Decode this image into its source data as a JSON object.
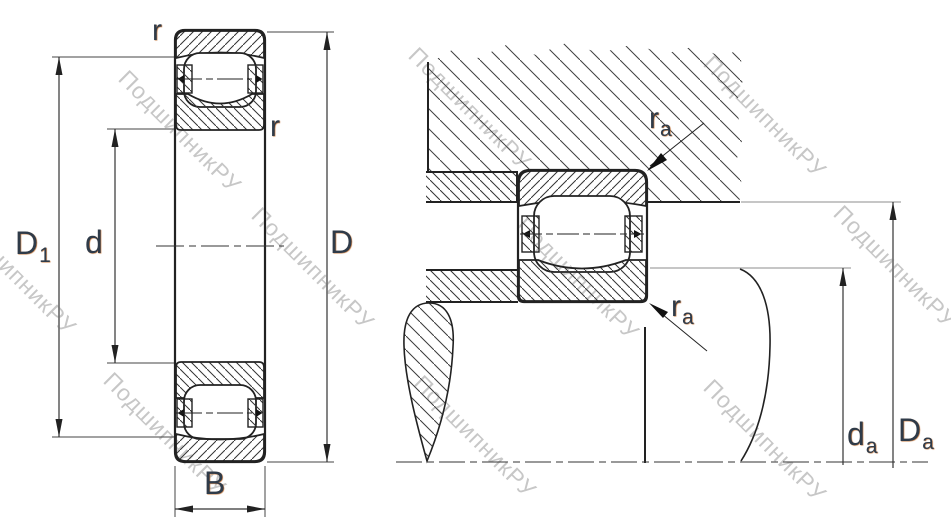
{
  "drawing_title": "Barrel roller bearing — cross section and mounting abutment drawing",
  "watermark": {
    "text": "ПодшипникРУ"
  },
  "left_view": {
    "labels": {
      "r_top": "r",
      "r_side": "r",
      "D1": {
        "base": "D",
        "sub": "1"
      },
      "d": "d",
      "D": "D",
      "B": "B"
    }
  },
  "right_view": {
    "labels": {
      "ra_top": {
        "base": "r",
        "sub": "a"
      },
      "ra_bottom": {
        "base": "r",
        "sub": "a"
      },
      "da": {
        "base": "d",
        "sub": "a"
      },
      "Da": {
        "base": "D",
        "sub": "a"
      }
    }
  }
}
